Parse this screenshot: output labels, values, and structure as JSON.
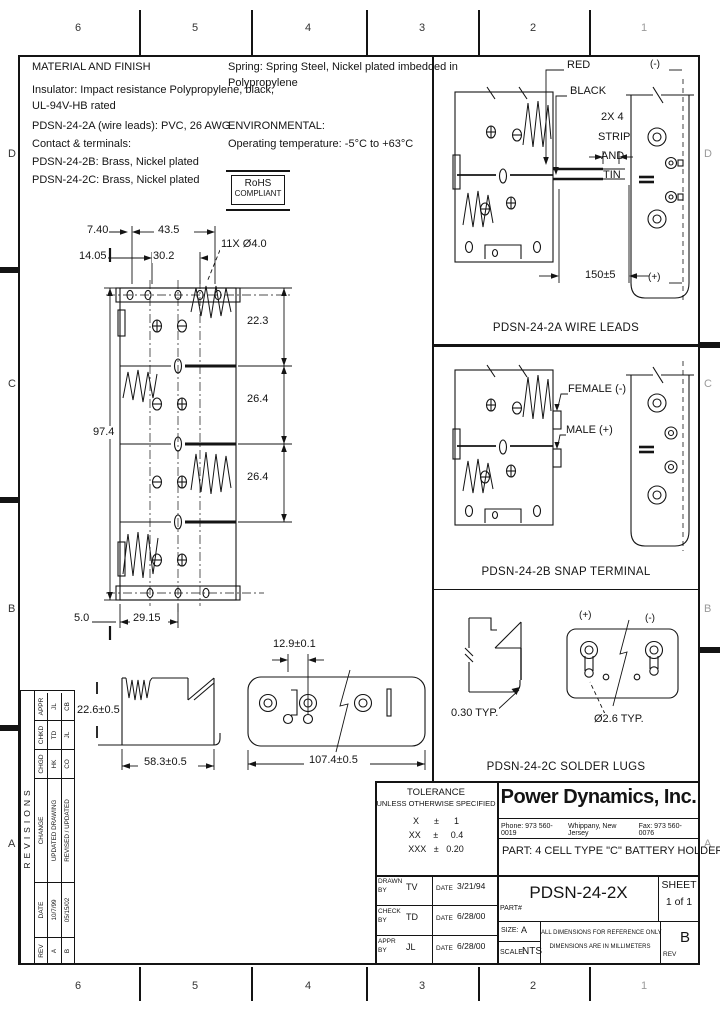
{
  "zones": {
    "top": [
      "6",
      "5",
      "4",
      "3",
      "2",
      "1"
    ],
    "bottom": [
      "6",
      "5",
      "4",
      "3",
      "2",
      "1"
    ],
    "left": [
      "D",
      "C",
      "B",
      "A"
    ],
    "right": [
      "D",
      "C",
      "B",
      "A"
    ]
  },
  "notes": {
    "title": "MATERIAL AND FINISH",
    "l1": "Insulator: Impact resistance Polypropylene, black,",
    "l2": "UL-94V-HB rated",
    "l3": "PDSN-24-2A (wire leads): PVC, 26 AWG",
    "l4": "Contact & terminals:",
    "l5": "PDSN-24-2B: Brass, Nickel plated",
    "l6": "PDSN-24-2C: Brass, Nickel plated",
    "r1": "Spring: Spring Steel, Nickel plated imbedded in",
    "r2": "Polypropylene",
    "env_title": "ENVIRONMENTAL:",
    "env": "Operating temperature: -5°C to +63°C",
    "rohs_line1": "RoHS",
    "rohs_line2": "COMPLIANT"
  },
  "main_view": {
    "dims": {
      "offset_x": "7.40",
      "outer_pitch": "43.5",
      "offset_x2": "14.05",
      "inner_pitch": "30.2",
      "holes": "11X Ø4.0",
      "cell1": "22.3",
      "cell2": "26.4",
      "cell3": "26.4",
      "height": "97.4",
      "edge": "5.0",
      "half_width": "29.15"
    }
  },
  "side_view": {
    "height": "22.6±0.5",
    "width": "58.3±0.5"
  },
  "bottom_view": {
    "pitch": "12.9±0.1",
    "width": "107.4±0.5"
  },
  "section_2a": {
    "wire_red": "RED",
    "wire_black": "BLACK",
    "strip_l1": "2X 4",
    "strip_l2": "STRIP",
    "strip_l3": "AND",
    "strip_l4": "TIN",
    "wire_length": "150±5",
    "neg": "(-)",
    "pos": "(+)",
    "caption": "PDSN-24-2A WIRE LEADS"
  },
  "section_2b": {
    "female": "FEMALE (-)",
    "male": "MALE (+)",
    "caption": "PDSN-24-2B SNAP TERMINAL"
  },
  "section_2c": {
    "pos": "(+)",
    "neg": "(-)",
    "thickness": "0.30 TYP.",
    "hole": "Ø2.6 TYP.",
    "caption": "PDSN-24-2C SOLDER LUGS"
  },
  "revisions": {
    "title": "REVISIONS",
    "headers": [
      "REV",
      "DATE",
      "CHANGE",
      "CHGD",
      "CHKD",
      "APPR"
    ],
    "rows": [
      [
        "A",
        "10/7/99",
        "UPDATED DRAWING",
        "HK",
        "TD",
        "JL"
      ],
      [
        "B",
        "05/15/02",
        "REVISED / UPDATED",
        "CO",
        "JL",
        "CB"
      ]
    ]
  },
  "title_block": {
    "tolerance_title": "TOLERANCE",
    "tolerance_sub": "UNLESS OTHERWISE SPECIFIED",
    "tol_x": "X      ±      1",
    "tol_xx": "XX     ±     0.4",
    "tol_xxx": "XXX   ±   0.20",
    "company": "Power Dynamics, Inc.",
    "phone": "Phone: 973 560-0019",
    "city": "Whippany, New Jersey",
    "fax": "Fax: 973 560-0076",
    "part_desc": "PART: 4 CELL TYPE \"C\" BATTERY HOLDER",
    "sign_rows": [
      {
        "role": "DRAWN",
        "by": "BY",
        "initials": "TV",
        "date_label": "DATE",
        "date": "3/21/94"
      },
      {
        "role": "CHECK",
        "by": "BY",
        "initials": "TD",
        "date_label": "DATE",
        "date": "6/28/00"
      },
      {
        "role": "APPR",
        "by": "BY",
        "initials": "JL",
        "date_label": "DATE",
        "date": "6/28/00"
      }
    ],
    "part_no_label": "PART#",
    "part_no": "PDSN-24-2X",
    "sheet_label": "SHEET",
    "sheet_value": "1 of 1",
    "size_label": "SIZE:",
    "size_value": "A",
    "scale_label": "SCALE:",
    "scale_value": "NTS",
    "note1": "ALL DIMENSIONS FOR REFERENCE ONLY",
    "note2": "DIMENSIONS ARE IN MILLIMETERS",
    "rev_label": "REV",
    "rev_value": "B"
  }
}
